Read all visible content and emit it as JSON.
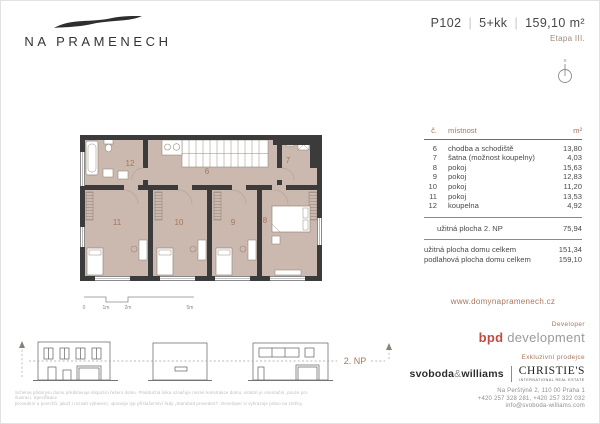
{
  "logo": {
    "name": "NA PRAMENECH"
  },
  "unit": {
    "code": "P102",
    "disposition": "5+kk",
    "area": "159,10 m²",
    "stage": "Etapa III.",
    "separator": "|"
  },
  "plan": {
    "room_numbers": {
      "r6": "6",
      "r7": "7",
      "r8": "8",
      "r9": "9",
      "r10": "10",
      "r11": "11",
      "r12": "12"
    },
    "scale_labels": {
      "s0": "0",
      "s1": "1m",
      "s2": "2m",
      "s5": "5m"
    },
    "compass_letter": "S",
    "floor_label": "2. NP"
  },
  "table": {
    "headers": {
      "num": "č.",
      "name": "místnost",
      "area": "m²"
    },
    "rows": [
      {
        "num": "6",
        "name": "chodba a schodiště",
        "area": "13,80"
      },
      {
        "num": "7",
        "name": "šatna (možnost koupelny)",
        "area": "4,03"
      },
      {
        "num": "8",
        "name": "pokoj",
        "area": "15,63"
      },
      {
        "num": "9",
        "name": "pokoj",
        "area": "12,83"
      },
      {
        "num": "10",
        "name": "pokoj",
        "area": "11,20"
      },
      {
        "num": "11",
        "name": "pokoj",
        "area": "13,53"
      },
      {
        "num": "12",
        "name": "koupelna",
        "area": "4,92"
      }
    ],
    "subtotal": {
      "label": "užitná plocha 2. NP",
      "value": "75,94"
    },
    "totals": [
      {
        "label": "užitná plocha domu celkem",
        "value": "151,34"
      },
      {
        "label": "podlahová plocha domu celkem",
        "value": "159,10"
      }
    ]
  },
  "footer": {
    "website": "www.domynapramenech.cz",
    "developer_label": "Developer",
    "developer_brand": "bpd",
    "developer_brand2": "development",
    "seller_label": "Exkluzivní prodejce",
    "agency_sw_1": "svoboda",
    "agency_sw_amp": "&",
    "agency_sw_2": "williams",
    "agency_christies": "CHRISTIE'S",
    "agency_christies_sub": "INTERNATIONAL REAL ESTATE",
    "address": "Na Perštýně 2, 110 00 Praha 1",
    "phones": "+420 257 328 281, +420 257 322 032",
    "email": "info@svoboda-williams.com",
    "disclaimer_line1": "Schéma půdorysu domu představuje dispozici řešení domu. Plná/tučná linka označuje nosné konstrukce domu, ostatní je orientační, pouze pro ilustraci. Specifikace",
    "disclaimer_line2": "provedení a povrchů, jakož i rozsah vybavení, upravuje typ příslušenství řady „Standard provedení\". Developer si vyhrazuje právo na změny."
  },
  "colors": {
    "accent": "#a8765a",
    "bpd_red": "#c14b3d",
    "plan_fill": "#cbb8ae",
    "wall": "#3b3b3b"
  }
}
